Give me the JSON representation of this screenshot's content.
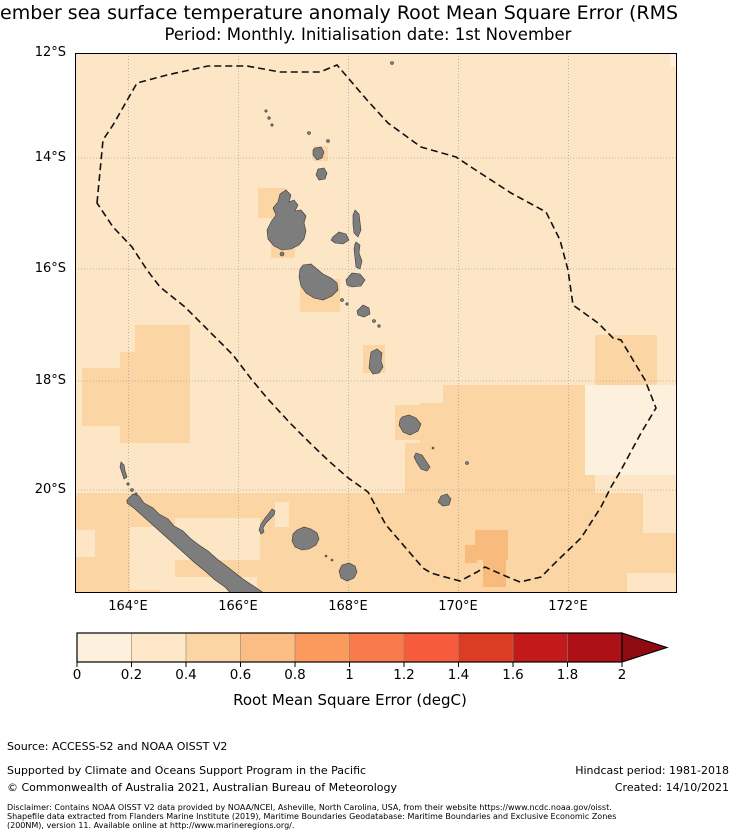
{
  "title": {
    "line1": "ember sea surface temperature anomaly Root Mean Square Error (RMS",
    "line2": "Period: Monthly. Initialisation date: 1st November"
  },
  "map": {
    "lat_ticks": [
      "12°S",
      "14°S",
      "16°S",
      "18°S",
      "20°S"
    ],
    "lon_ticks": [
      "164°E",
      "166°E",
      "168°E",
      "170°E",
      "172°E"
    ],
    "land_color": "#7d7d7d",
    "eez_boundary": "black dashed polygon",
    "ocean_bin_colors": {
      "0-0.2": "#fdf0dc",
      "0.2-0.4": "#fde6c6",
      "0.4-0.6": "#fbd5a3",
      "0.6-0.8": "#f9ba7d"
    }
  },
  "colorbar": {
    "label": "Root Mean Square Error (degC)",
    "ticks": [
      "0",
      "0.2",
      "0.4",
      "0.6",
      "0.8",
      "1",
      "1.2",
      "1.4",
      "1.6",
      "1.8",
      "2"
    ],
    "segment_colors": [
      "#fdf0dc",
      "#fde7c8",
      "#fbd5a3",
      "#fbbd84",
      "#fa9b5d",
      "#f97a4c",
      "#f65b3c",
      "#dc3b24",
      "#c2191b",
      "#ad1016"
    ],
    "over_arrow_color": "#8d0b11"
  },
  "footer": {
    "source": "Source: ACCESS-S2 and NOAA OISST V2",
    "supported": "Supported by Climate and Oceans Support Program in the Pacific",
    "copyright": "© Commonwealth of Australia 2021, Australian Bureau of Meteorology",
    "hindcast": "Hindcast period: 1981-2018",
    "created": "Created: 14/10/2021",
    "disclaimer_line1": "Disclaimer: Contains NOAA OISST V2 data provided by NOAA/NCEI, Asheville, North Carolina, USA, from their website https://www.ncdc.noaa.gov/oisst.",
    "disclaimer_line2": "Shapefile data extracted from Flanders Marine Institute (2019), Maritime Boundaries Geodatabase: Maritime Boundaries and Exclusive Economic Zones",
    "disclaimer_line3": "(200NM), version 11. Available online at http://www.marineregions.org/."
  },
  "chart_data": {
    "type": "heatmap",
    "colorbar_label": "Root Mean Square Error (degC)",
    "colorbar_range": [
      0,
      2
    ],
    "colorbar_step": 0.2,
    "colorbar_extends_above_max": true,
    "lat_ticks_deg_south": [
      12,
      14,
      16,
      18,
      20
    ],
    "lon_ticks_deg_east": [
      164,
      166,
      168,
      170,
      172
    ],
    "value_summary": "Most of the domain is in the 0.2-0.4 and 0.4-0.6 degC bins; scattered 0-0.2 patches near New Caledonia and east of the EEZ boundary; one 0.6-0.8 patch near 170E / 21.5S"
  }
}
